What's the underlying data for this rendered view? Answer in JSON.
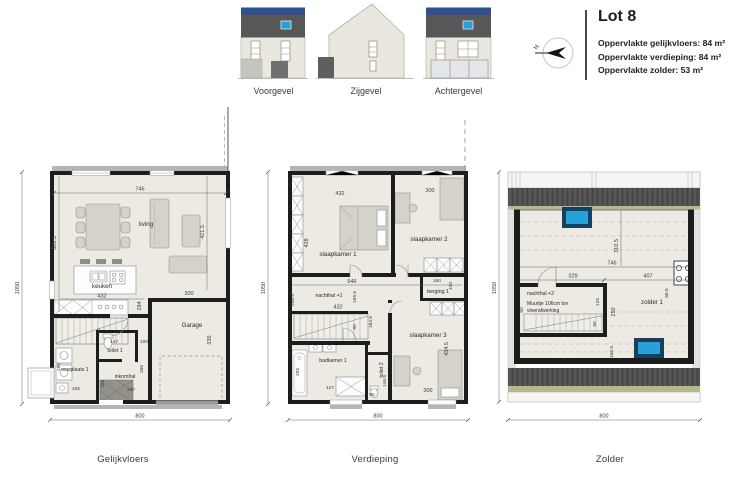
{
  "header": {
    "lot_title": "Lot 8",
    "area_lines": [
      "Oppervlakte gelijkvloers: 84 m²",
      "Oppervlakte verdieping: 84 m²",
      "Oppervlakte zolder: 53 m²"
    ],
    "compass_label": "N",
    "elevation_labels": [
      "Voorgevel",
      "Zijgevel",
      "Achtergevel"
    ]
  },
  "plans": {
    "gelijkvloers": {
      "label": "Gelijkvloers",
      "rooms": {
        "living": "living",
        "keuken": "keuken",
        "garage": "Garage",
        "toilet": "toilet 1",
        "wasplaats": "wasplaats 1",
        "inkomhal": "inkomhal"
      },
      "dims": {
        "top": "746",
        "left": "601.5",
        "right": "421.5",
        "keuken_w": "432",
        "keuken_h": "284",
        "garage_w": "300",
        "garage_h": "535",
        "toilet_w": "147",
        "naast_toilet": "100",
        "wasplaats_w": "165",
        "wasplaats_h": "185",
        "inkomhal_w": "257",
        "inkomhal_h": "155",
        "hal_h": "266",
        "stairs": "90",
        "total_w": "800",
        "total_h": "1050"
      }
    },
    "verdieping": {
      "label": "Verdieping",
      "rooms": {
        "sk1": "slaapkamer 1",
        "sk2": "slaapkamer 2",
        "nachthal": "nachthal +1",
        "berging": "berging 1",
        "sk3": "slaapkamer 3",
        "badkamer": "badkamer 1",
        "toilet": "toilet 2"
      },
      "dims": {
        "sk1_w": "432",
        "sk1_h": "428",
        "sk2_w": "300",
        "hal_top": "546",
        "hal_mid": "165.5",
        "hal_left": "266.5",
        "hal_w": "432",
        "berging_w": "160",
        "berging_h": "100",
        "sk3_l": "184.5",
        "sk3_r": "434.5",
        "sk3_w": "300",
        "bad_w": "127",
        "bad_h": "255",
        "toilet_w": "95",
        "toilet_h": "146.5",
        "stairs": "90",
        "total_w": "800",
        "total_h": "1050"
      }
    },
    "zolder": {
      "label": "Zolder",
      "rooms": {
        "nachthal": "nachthal +2",
        "zolder": "zolder 1"
      },
      "note_line1": "Muurtje 106cm tov",
      "note_line2": "vloerafwerking",
      "dims": {
        "top_w": "746",
        "top_h": "310.5",
        "left_seg": "329",
        "right_seg": "407",
        "flue": "66.5",
        "hal_h": "126",
        "hal_small": "50",
        "stairs": "90",
        "mid_h": "250",
        "low_h": "166.5",
        "total_w": "800",
        "total_h": "1050"
      }
    }
  }
}
